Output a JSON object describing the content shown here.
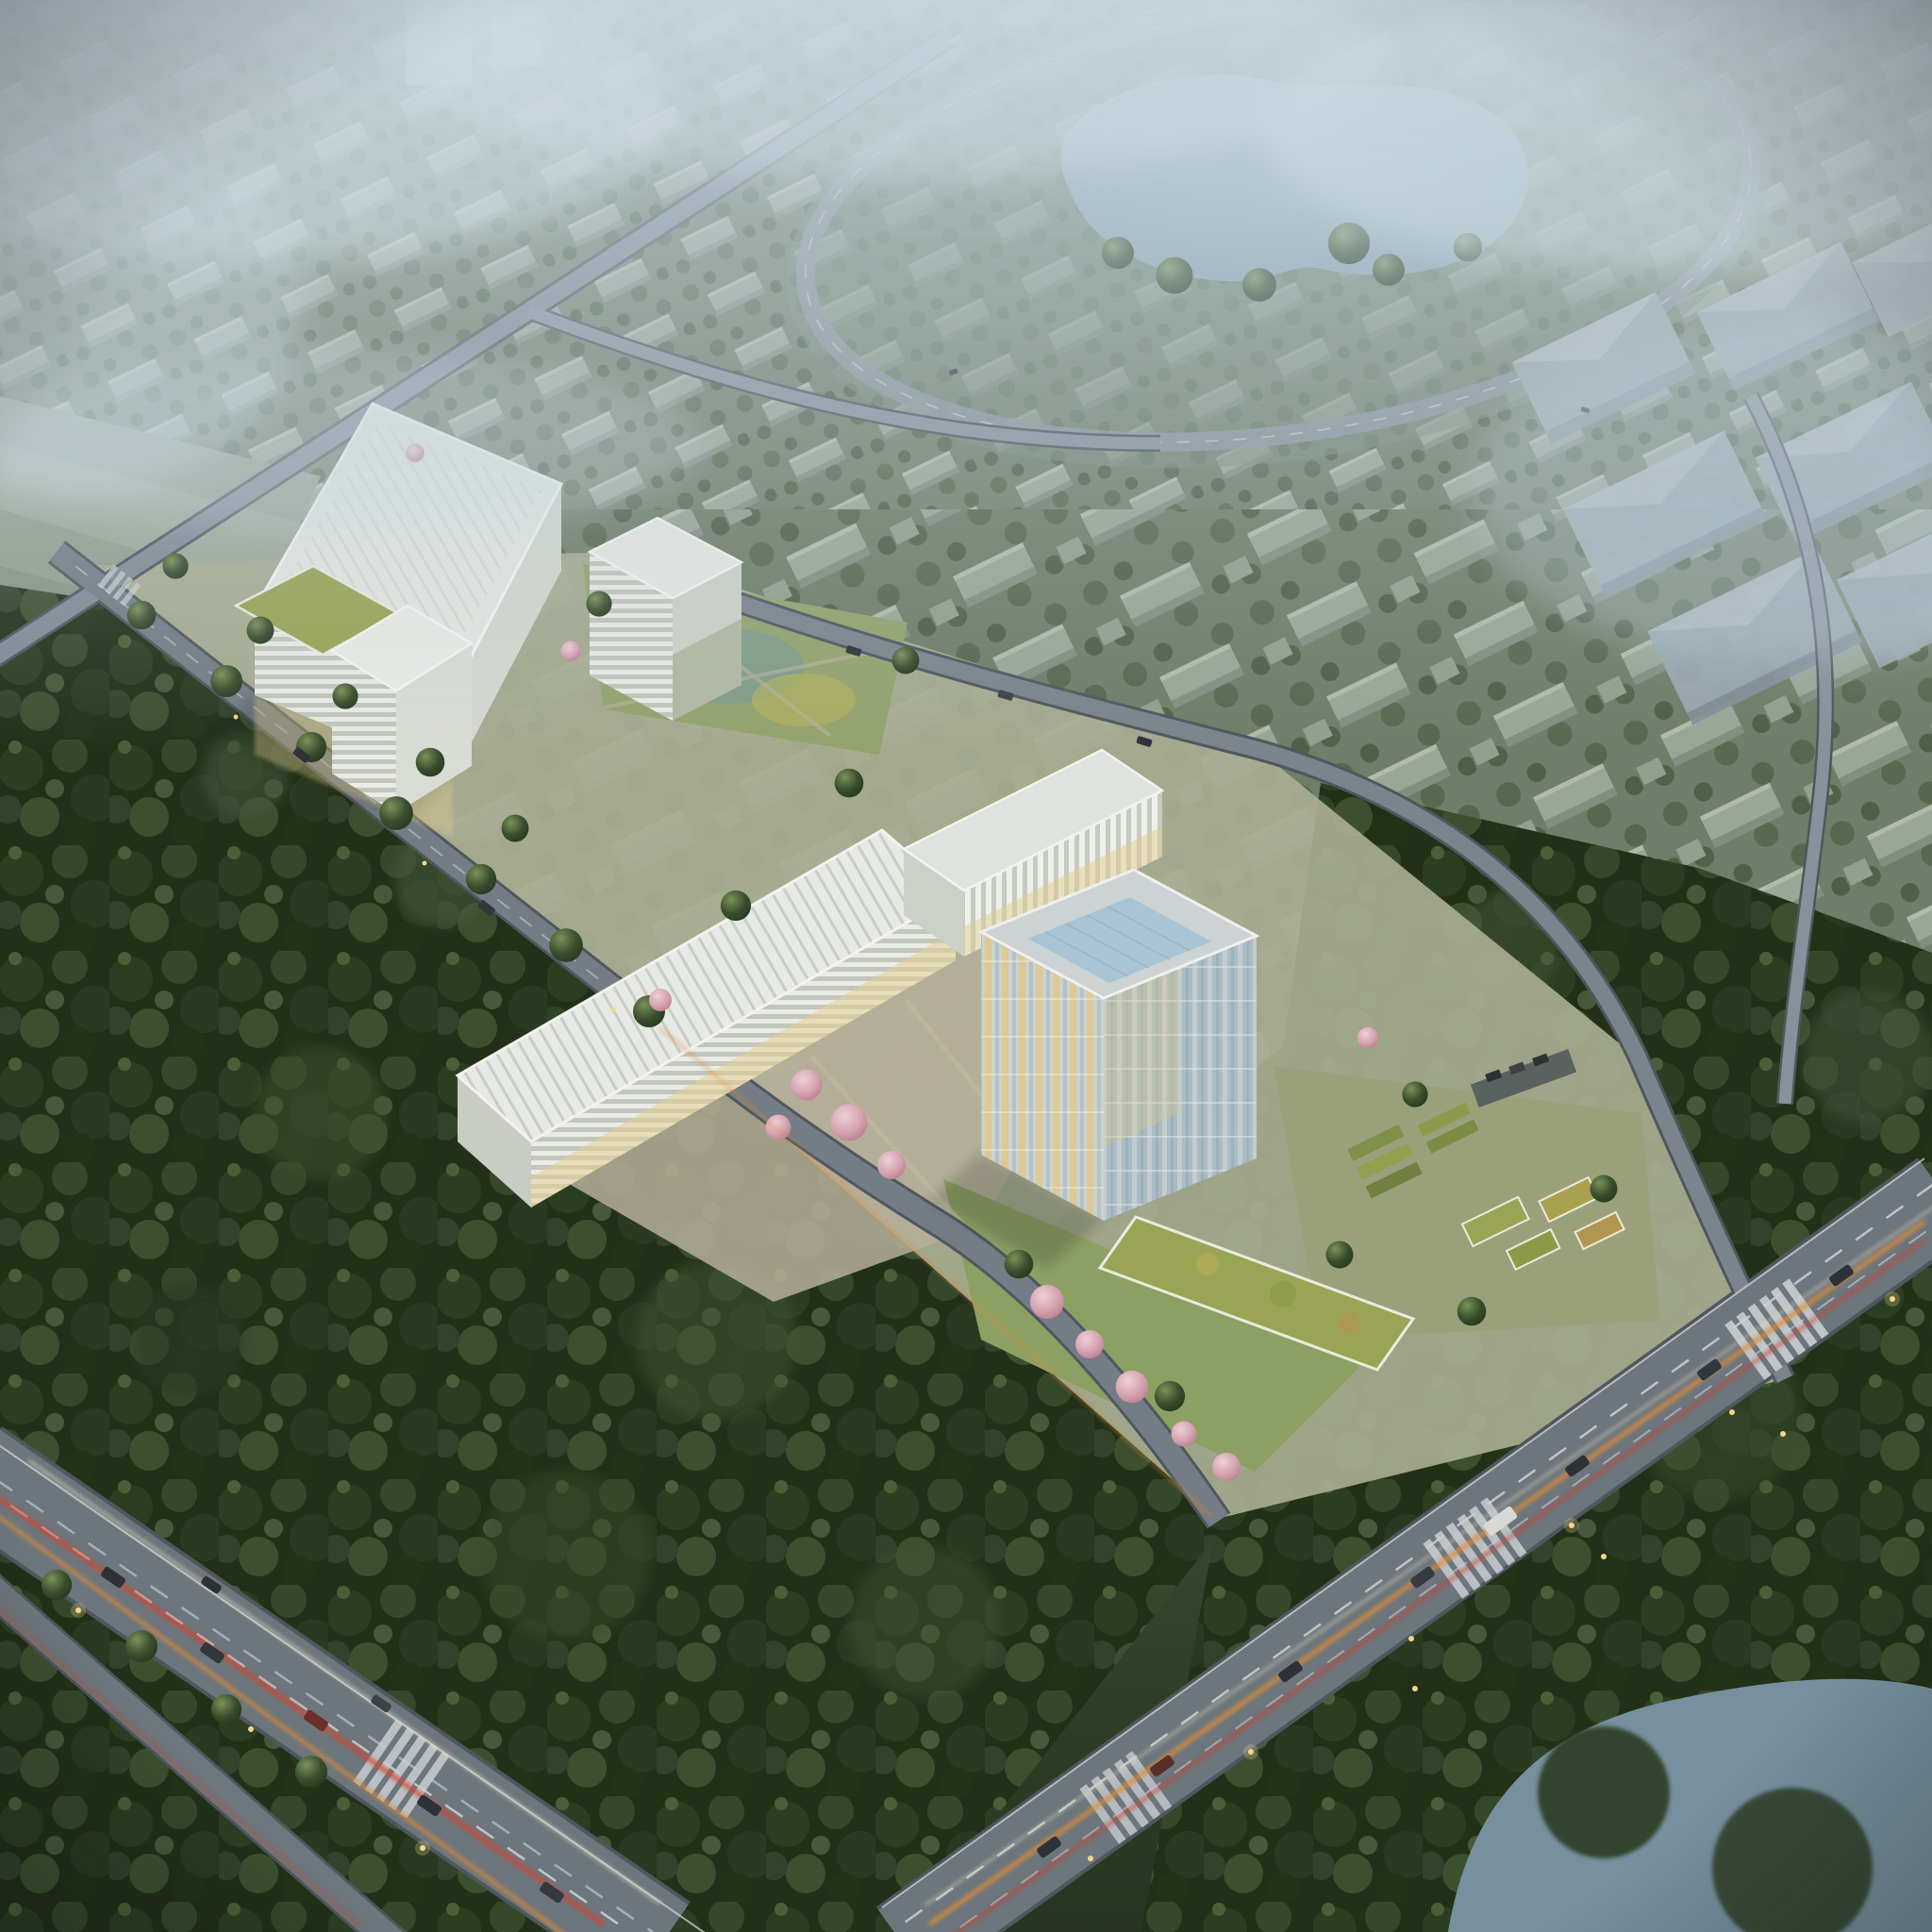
{
  "scene": {
    "type": "aerial-architectural-rendering",
    "time_of_day": "dusk-haze",
    "campus_buildings": [
      {
        "id": "main-hall",
        "form": "large white box, horizontal striped facade, pale mottled roof"
      },
      {
        "id": "annex-box",
        "form": "small white box with green-roof podium"
      },
      {
        "id": "stepped-tower",
        "form": "mid-rise tower, horizontal white/green banding"
      },
      {
        "id": "linear-slab",
        "form": "long low slab, diagonal striped roof, lit base"
      },
      {
        "id": "office-bar",
        "form": "mid-rise bar, vertical white mullions"
      },
      {
        "id": "glass-tower",
        "form": "glass cube, warm lit curtain wall, blue roof skylight"
      },
      {
        "id": "green-roof-pavilion",
        "form": "low bar with planted yellow-green roof"
      }
    ],
    "environment": [
      "residential-grid-rows-with-trees",
      "heart-shaped-lake",
      "lake-ring-road",
      "warehouse-halls",
      "dense-forest-south",
      "river-corner-southeast",
      "boulevard-with-light-trails-southwest",
      "boulevard-with-light-trails-southeast",
      "tree-lined-campus-road",
      "cherry-blossom-gardens",
      "terraced-garden-plots"
    ]
  },
  "colors": {
    "sky_top": "#b7c7d0",
    "mid_ground": "#8fa090",
    "low_ground": "#3c4c33",
    "city_roof": "#9aa696",
    "city_tree": "#56684d",
    "field": "#95a090",
    "lake": "#93abb9",
    "ring_road": "#8d98a2",
    "warehouse": "#9fadb3",
    "forest_base": "#223018",
    "forest_hi": "#44583380",
    "campus_ground": "#a9ae93",
    "lawn": "#93a36d",
    "lawn_teal": "#6f97a0",
    "plaza": "#b6af9a",
    "roof_white": "#e4e6e1",
    "facade_warm": "#e7cf8e",
    "skylight": "#a9c4d4",
    "green_roof": "#9aa455",
    "blossom": "#d9a8b4",
    "road_casing": "#4f575e",
    "road_fill": "#6d767d",
    "road_minor": "#848e98",
    "road_mark": "#d2d7db",
    "trail_red": "#d4452c",
    "trail_orange": "#e08b36",
    "trail_white": "#efe6c8",
    "car_body": "#2c3237",
    "light_dot": "#f3d68a",
    "river": "#77909f",
    "haze": "#bed0d8"
  }
}
